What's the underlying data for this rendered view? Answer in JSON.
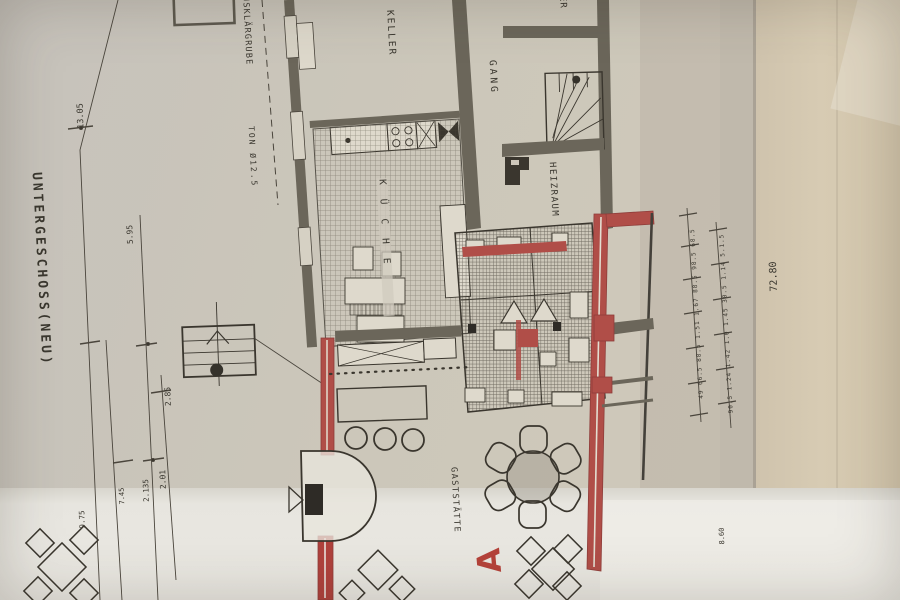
{
  "drawing": {
    "title": "UNTERGESCHOSS(NEU)",
    "type_note": "hand-drawn basement floor plan photo"
  },
  "labels": {
    "title": "UNTERGESCHOSS(NEU)",
    "klaergrube": "USKLÄRGRUBE",
    "ton_pipe": "TON Ø12.5",
    "keller": "KELLER",
    "kueche": "KÜCHE",
    "gang": "GANG",
    "heizraum": "HEIZRAUM",
    "gaststaette": "GASTSTÄTTE",
    "er_partial": "ER",
    "marker_a": "A"
  },
  "dimensions": {
    "d13_05": "13.05",
    "d5_95": "5.95",
    "d2_85": "2.85",
    "d2_01": "2.01",
    "d2_135": "2.135",
    "d7_45": "7.45",
    "d9_75": "9.75",
    "d72_80": "72.80",
    "d8_60": "8.60",
    "right_chain_inner": [
      "49",
      "66.5",
      "88.5",
      "1.51",
      "1.67",
      "88.5",
      "98.5",
      "68.5"
    ],
    "right_chain_outer": [
      "90.5",
      "1.24",
      "1.42",
      "1.0",
      "1.45",
      "30.5",
      "1.14",
      "5.1.5"
    ]
  },
  "colors": {
    "paper": "#cac4b7",
    "paper_light": "#eae8e2",
    "paper_warm": "#d4c8b0",
    "ink": "#3a362e",
    "wall_gray": "#6b665a",
    "red_wall": "#b04e48",
    "red_marker": "#b5423a"
  }
}
